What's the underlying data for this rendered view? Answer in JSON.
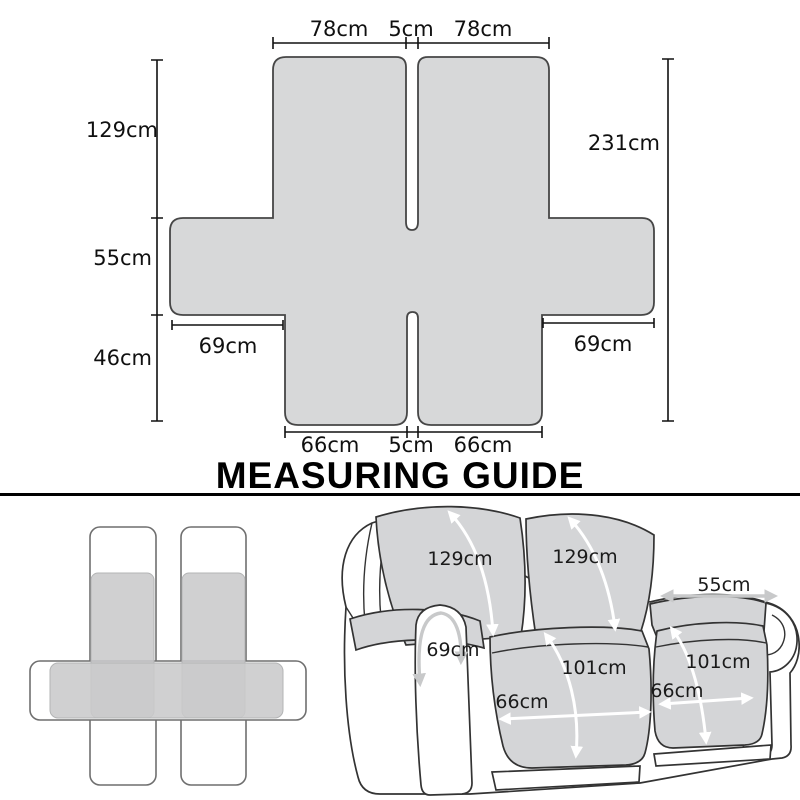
{
  "heading": {
    "text": "MEASURING GUIDE"
  },
  "colors": {
    "pattern_fill": "#d7d8d9",
    "pattern_outline": "#464646",
    "dimension_line": "#111111",
    "label_text": "#101010",
    "sofa_cover_fill": "#d4d5d7",
    "sofa_outline": "#333333",
    "arrow_white": "#ffffff",
    "arrow_gray": "#c8c9ca",
    "schematic_outline": "#6f6f6f",
    "schematic_fill": "#c9cacb"
  },
  "pattern": {
    "top_width_left": "78cm",
    "top_gap": "5cm",
    "top_width_right": "78cm",
    "back_height": "129cm",
    "middle_depth": "55cm",
    "front_drop": "46cm",
    "total_height": "231cm",
    "arm_left": "69cm",
    "arm_right": "69cm",
    "bottom_width_left": "66cm",
    "bottom_gap": "5cm",
    "bottom_width_right": "66cm"
  },
  "sofa": {
    "back_left": "129cm",
    "back_right": "129cm",
    "armrest_top": "55cm",
    "armrest_front": "69cm",
    "seat_depth_left": "101cm",
    "seat_depth_right": "101cm",
    "seat_width_left": "66cm",
    "seat_width_right": "66cm"
  }
}
